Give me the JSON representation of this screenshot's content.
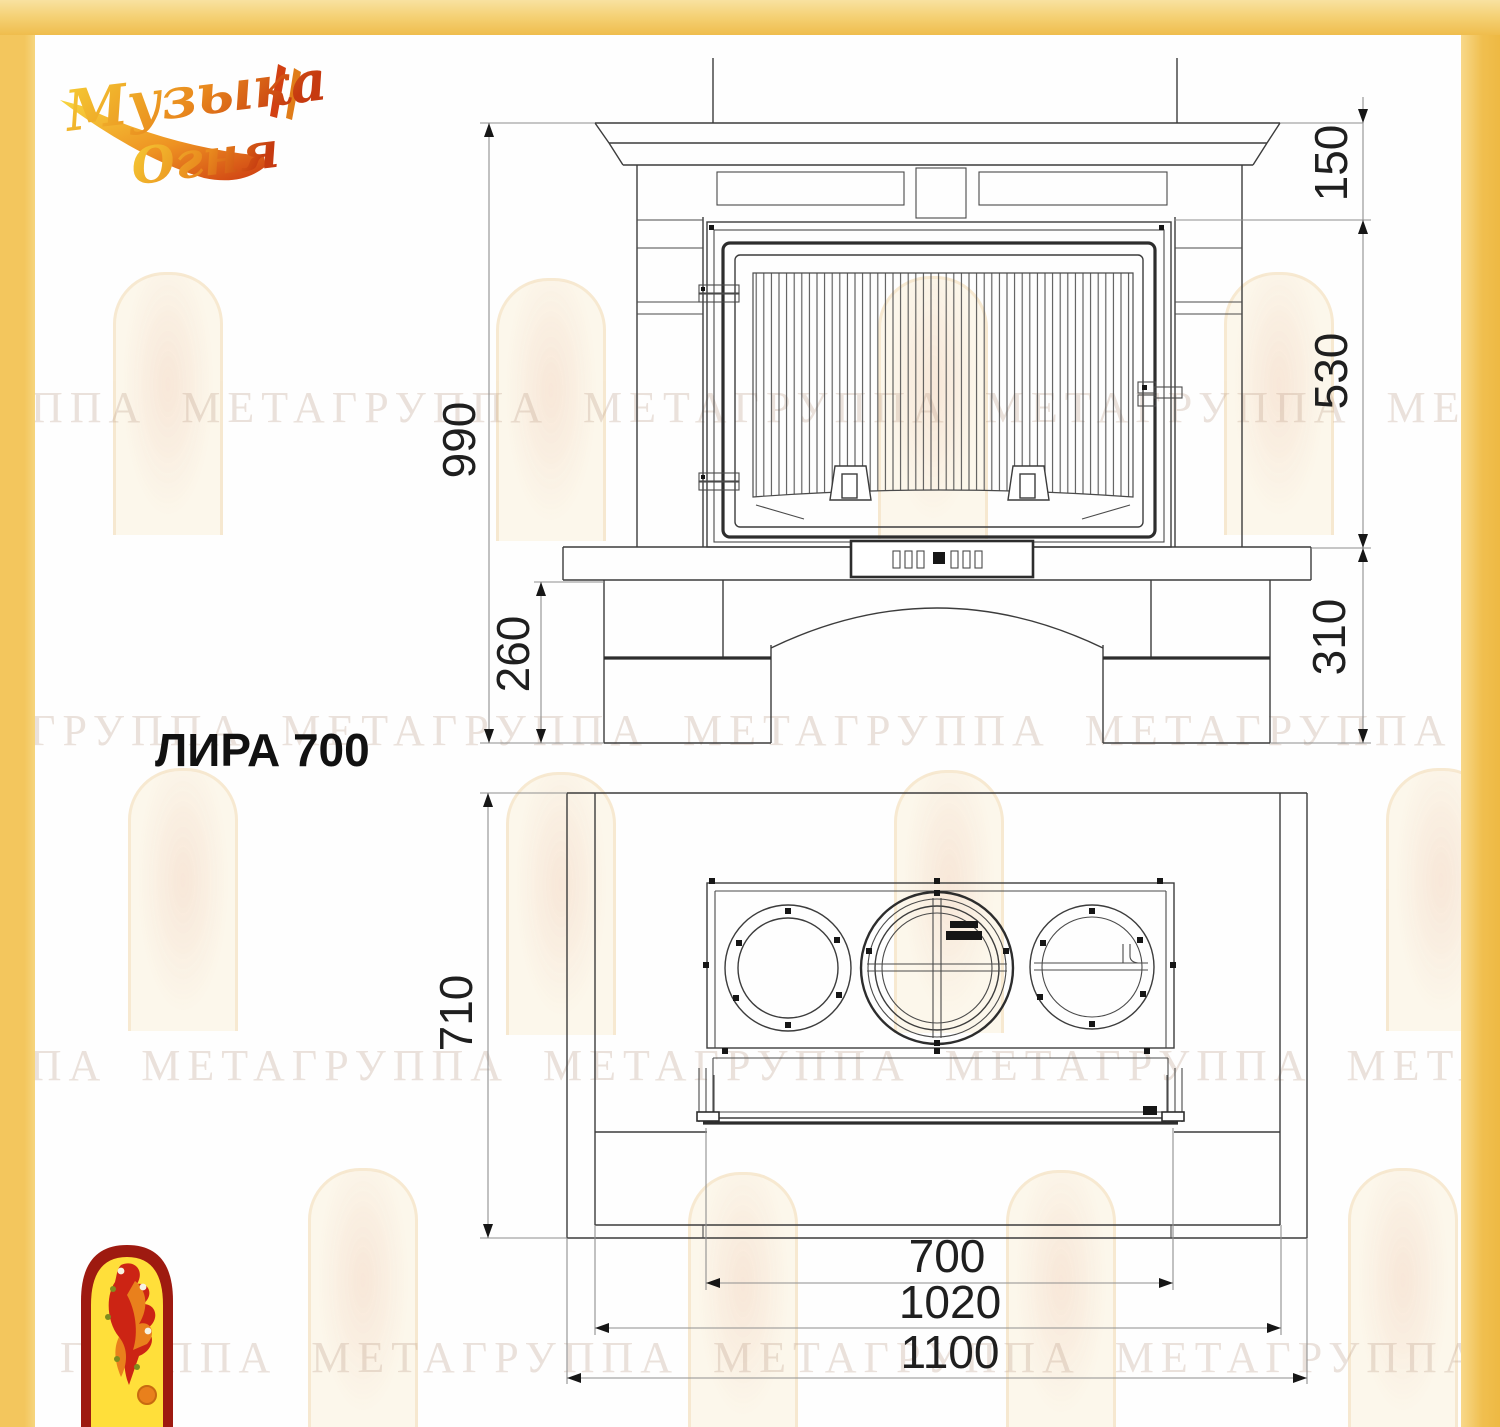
{
  "brand": {
    "line1": "Музыка",
    "line2": "Огня"
  },
  "title": "ЛИРА 700",
  "watermark_text": "ГРУППА МЕТАГРУППА МЕТАГРУППА МЕТАГРУППА МЕТА",
  "front_view": {
    "height": "990",
    "mantel_drop": "150",
    "firebox_height": "530",
    "base_height": "310",
    "hearth_height": "260"
  },
  "plan_view": {
    "depth": "710",
    "firebox_width": "700",
    "body_width": "1020",
    "overall_width": "1100"
  },
  "colors": {
    "frame_yellow": "#f2c55c",
    "drawing_line": "#3c3c3c",
    "dimension_line": "#8f8f8f",
    "logo_red": "#9e1a10",
    "logo_yellow": "#ffdf3a"
  }
}
